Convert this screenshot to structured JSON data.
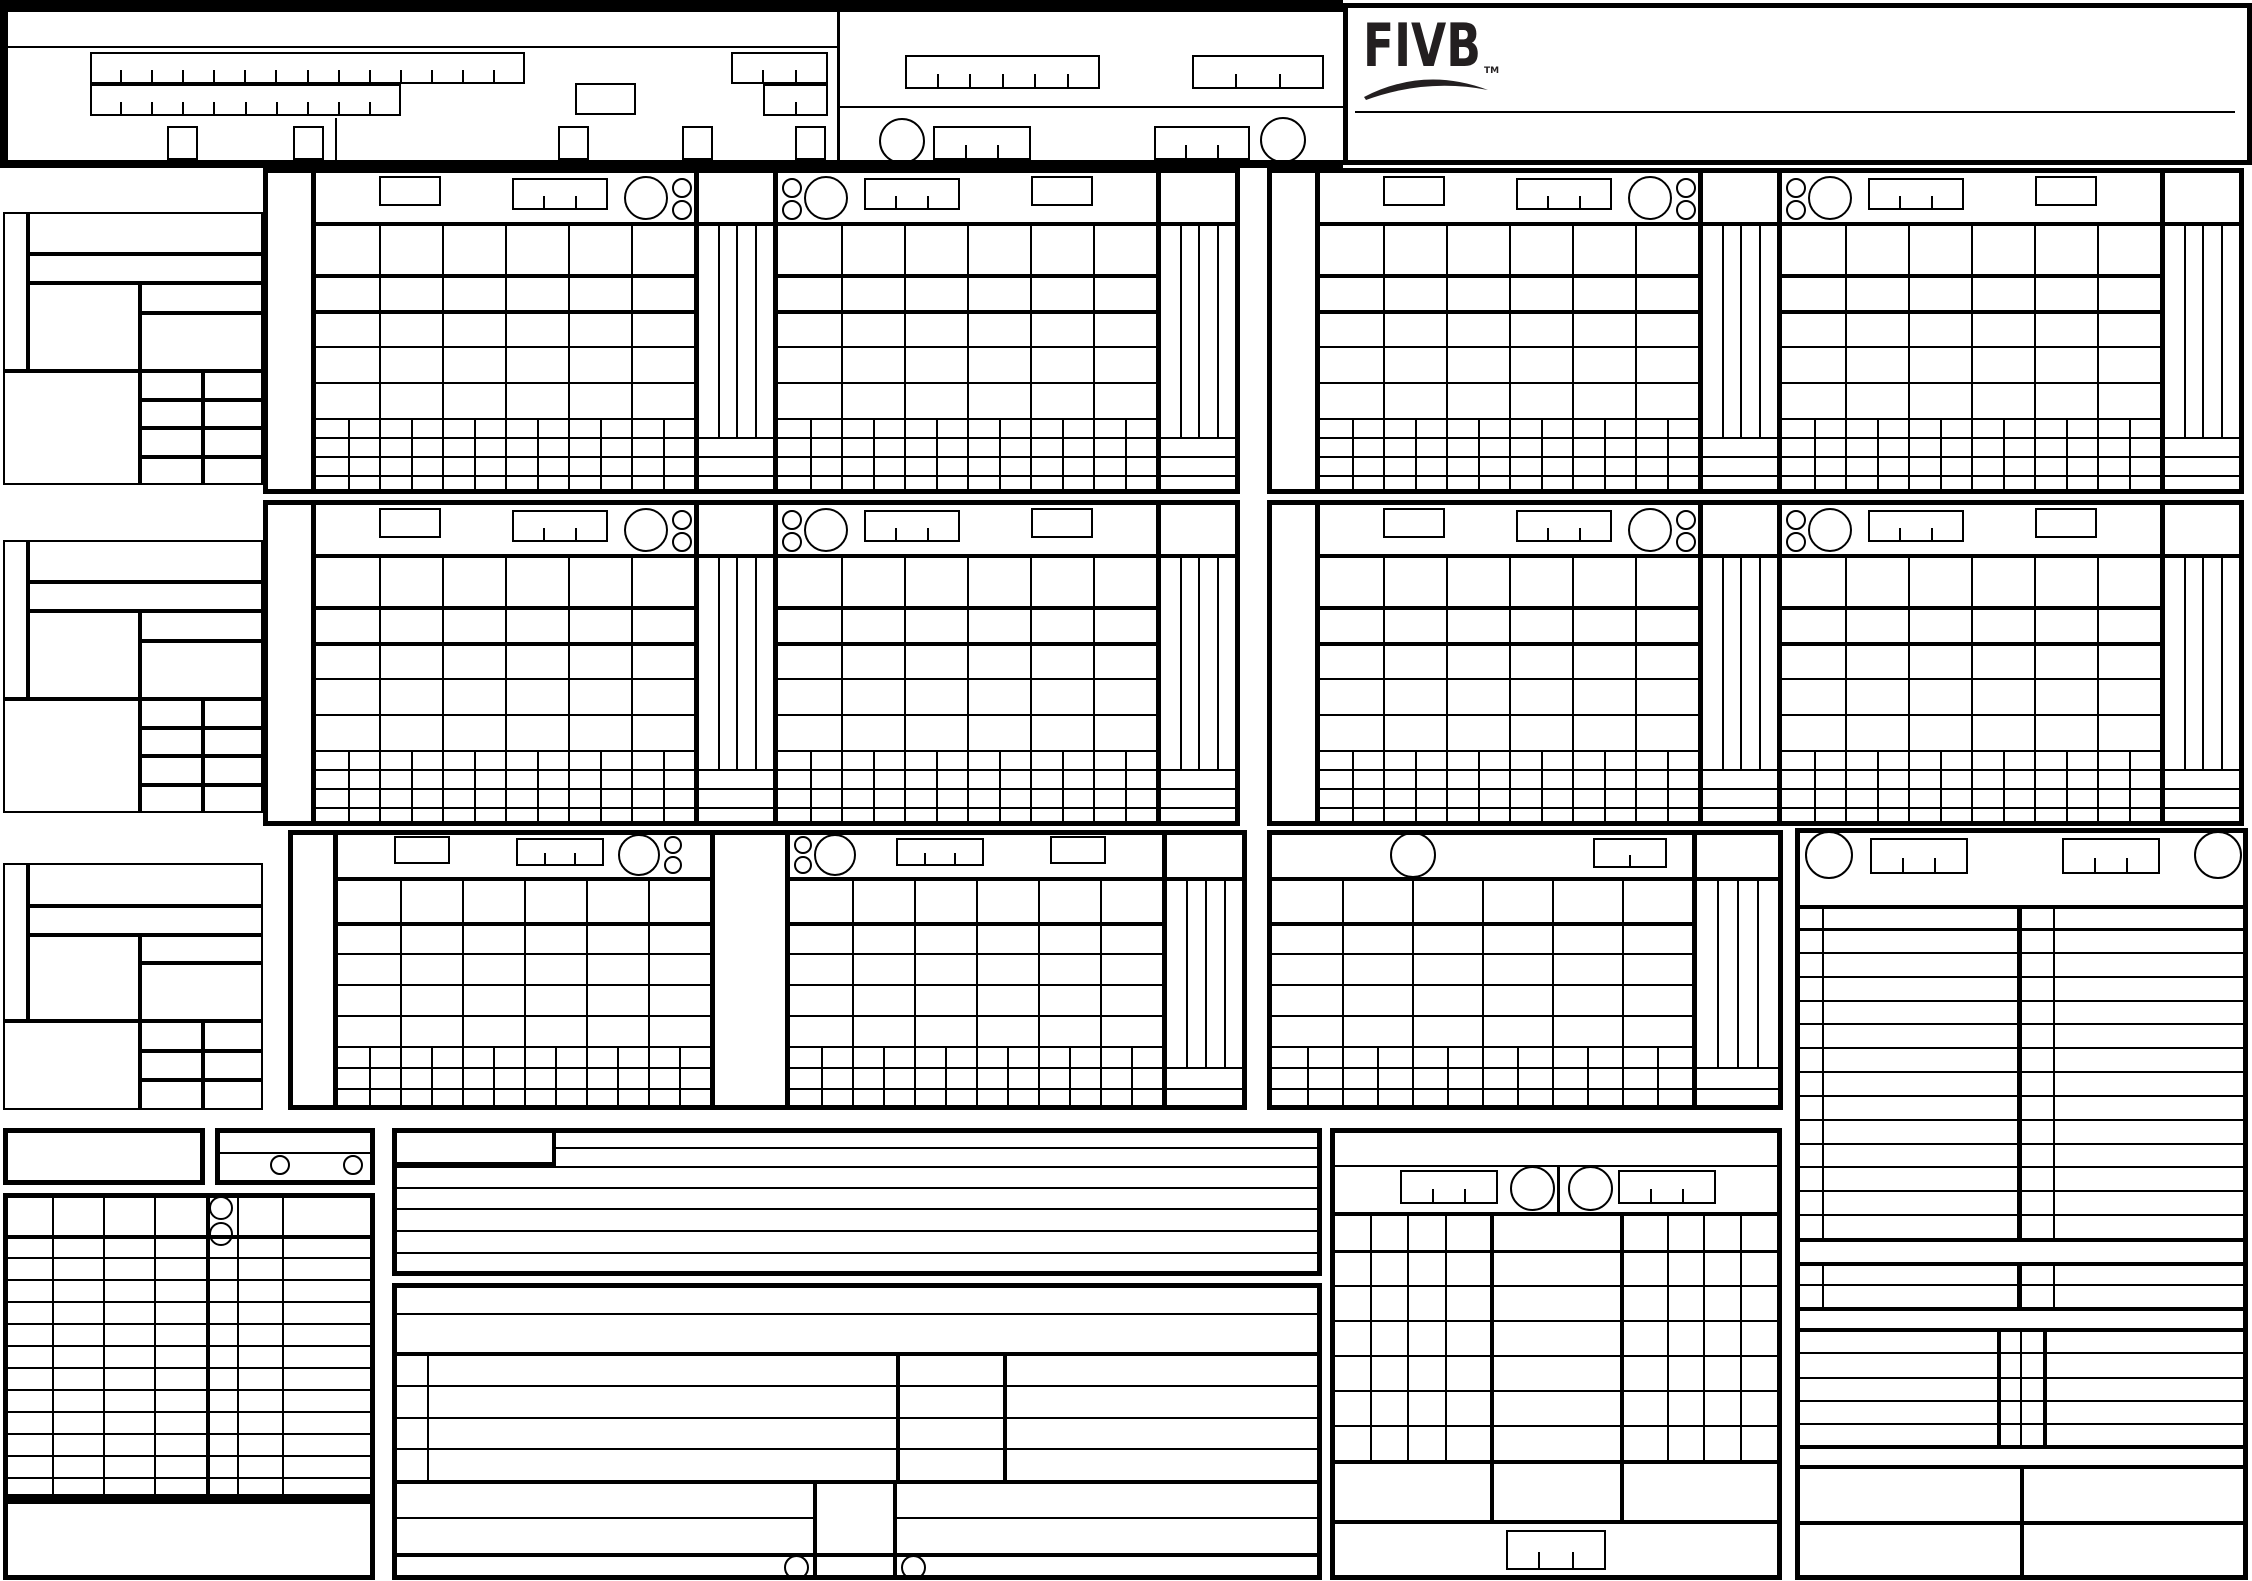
{
  "page": {
    "width": 2252,
    "height": 1581,
    "background": "#ffffff",
    "ink": "#000000"
  },
  "logo": {
    "text": "FIVB",
    "tm": "TM",
    "color": "#231f20"
  },
  "header": {
    "long_comb_segments": 14,
    "short_comb_segments": 10,
    "date_comb_segments": 3,
    "small_comb_segments": 2,
    "right_comb1_segments": 6,
    "right_comb2_segments": 3,
    "circle_comb_segments": 3,
    "checkbox_count": 5
  },
  "sets": {
    "blocks": [
      {
        "label": "set-1",
        "x": 263,
        "y": 168
      },
      {
        "label": "set-2",
        "x": 1267,
        "y": 168
      },
      {
        "label": "set-3",
        "x": 263,
        "y": 500
      },
      {
        "label": "set-4",
        "x": 1267,
        "y": 500
      }
    ],
    "columns": 6,
    "lineup_rows": 5,
    "tally_rows": 4,
    "points_strips": 4,
    "header_comb_segments": 3
  },
  "set5": {
    "label": "set-5",
    "columns": 6,
    "lineup_rows": 5,
    "tally_rows": 3,
    "points_strips": 4
  },
  "sidebar_groups": [
    {
      "y": 212,
      "time_rows": 4
    },
    {
      "y": 540,
      "time_rows": 4
    },
    {
      "y": 863,
      "time_rows": 3
    }
  ],
  "sanctions": {
    "rows": 12,
    "left_columns": 4,
    "header_circles": 2
  },
  "results": {
    "data_rows": 6,
    "side_columns": 4,
    "comb_segments": 3
  },
  "teams": {
    "player_rows": 13,
    "libero_rows": 2,
    "officials_rows": 5,
    "signature_rows": 2,
    "comb_segments": 3
  }
}
